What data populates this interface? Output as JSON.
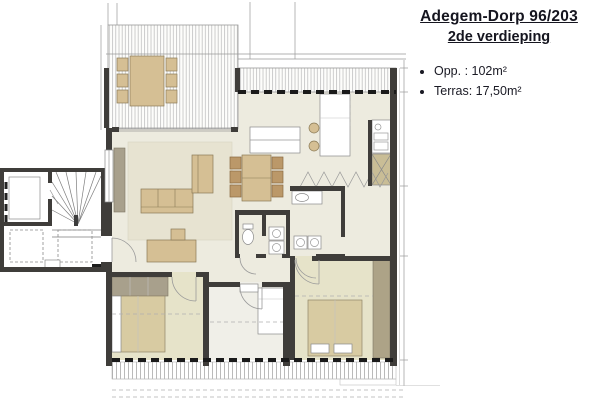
{
  "title_block": {
    "line1": "Adegem-Dorp 96/203",
    "line2": "2de verdieping",
    "bullets": [
      "Opp. : 102m²",
      "Terras: 17,50m²"
    ]
  },
  "plan": {
    "type": "apartment-floor-plan",
    "rooms": [
      "terrace-top-left",
      "terrace-top",
      "living-room",
      "dining-area",
      "kitchen",
      "bathroom",
      "wc",
      "laundry-closet",
      "hallway",
      "bedroom-1",
      "bedroom-2",
      "bedroom-3",
      "stairwell",
      "elevator"
    ],
    "furniture": [
      "terrace-table-with-6-chairs",
      "dining-table-with-6-chairs",
      "sofa",
      "armchair",
      "tv-cabinet",
      "desk-with-chair",
      "kitchen-island-with-stools",
      "toilet",
      "washbasin",
      "washer-dryer",
      "double-bed",
      "single-bed",
      "wardrobes",
      "technical-shaft"
    ]
  },
  "colors": {
    "wall": "#3f3d3a",
    "floor": "#edebdf",
    "floor2": "#e6e3c9",
    "room2": "#f0efe8",
    "rug": "#e7e3d1",
    "furn": "#d5bf94",
    "wood": "#bb9869",
    "bed": "#d8cba2",
    "ward": "#a8a08c",
    "ward2": "#ada387",
    "shaft": "#c9bd96",
    "line": "#999999",
    "title": "#15151f"
  }
}
